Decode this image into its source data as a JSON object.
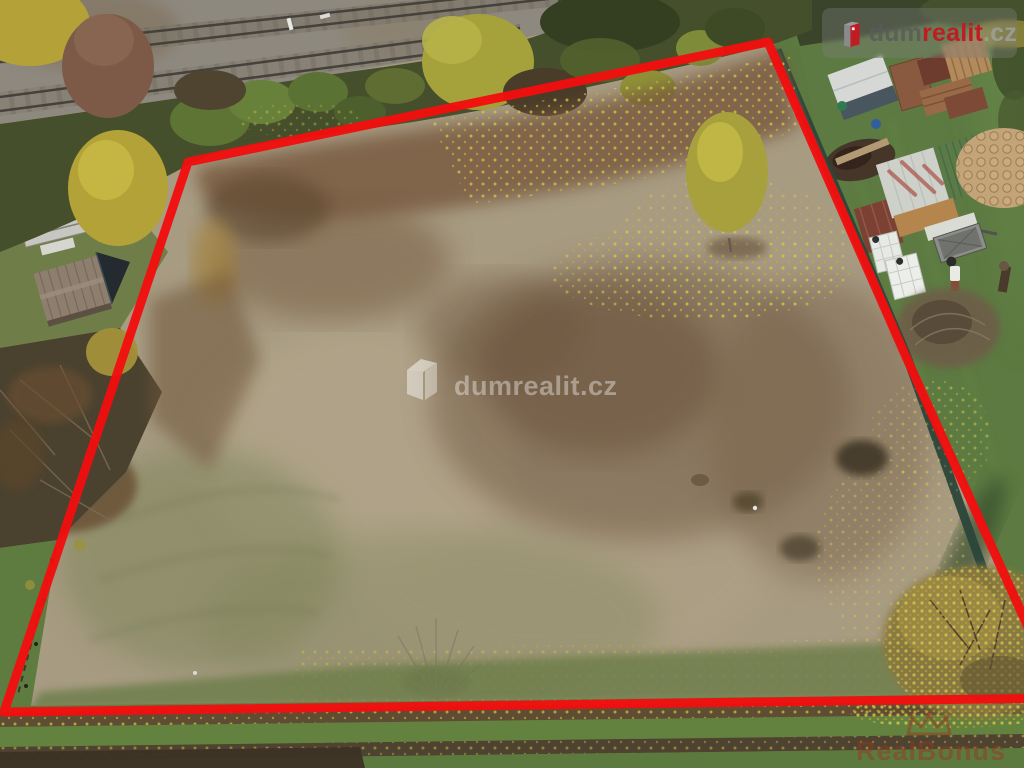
{
  "scene": {
    "type": "aerial-drone-photo",
    "colors": {
      "field_tan": "#a79b82",
      "lawn_green": "#5c7a41",
      "ballast_gray": "#8e897f",
      "fence_green": "#2b463a",
      "foliage_dark": "#454f2c",
      "foliage_yellow": "#b3a238",
      "leaf_brown": "#77593c",
      "grass_band": "#5a7740",
      "boundary_red": "#f10f0f"
    },
    "features": [
      "railway-tracks",
      "autumn-trees",
      "vacant-plot",
      "red-boundary-outline",
      "neighbor-sheds",
      "wood-piles",
      "lawn",
      "field-path"
    ]
  },
  "boundary": {
    "points": "188,162 768,42 903,350 1060,698 4,712",
    "color": "#f10f0f",
    "stroke_width": 9
  },
  "watermark_center": {
    "text": "dumrealit.cz"
  },
  "logo_badge": {
    "prefix": "dum",
    "accent": "realit",
    "suffix": ".cz"
  },
  "watermark_bonus": {
    "text": "RealBonus"
  },
  "css_vars": {
    "--badge-bg": "rgba(128,128,128,0.35)",
    "--badge-prefix": "rgba(92,92,92,0.85)",
    "--badge-accent": "#c01c24",
    "--badge-suffix": "rgba(160,160,160,0.85)",
    "--wm-white": "rgba(255,255,255,0.38)",
    "--bonus-color": "rgba(148,56,34,0.5)"
  }
}
